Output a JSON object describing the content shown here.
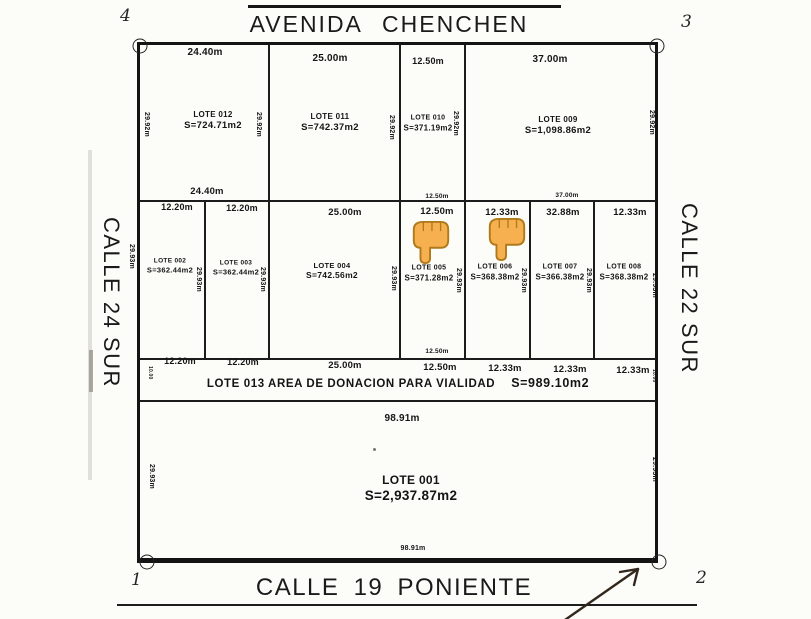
{
  "streets": {
    "top": "AVENIDA CHENCHEN",
    "bottom": "CALLE 19 PONIENTE",
    "left": "CALLE 24 SUR",
    "right": "CALLE 22 SUR"
  },
  "donation_strip": {
    "label": "LOTE 013 AREA DE DONACION PARA VIALIDAD",
    "area": "S=989.10m2"
  },
  "corner_markers": [
    {
      "label": "4",
      "lx": 120,
      "ly": 6,
      "cx": 140,
      "cy": 46
    },
    {
      "label": "3",
      "lx": 681,
      "ly": 12,
      "cx": 657,
      "cy": 46
    },
    {
      "label": "1",
      "lx": 131,
      "ly": 570,
      "cx": 147,
      "cy": 562
    },
    {
      "label": "2",
      "lx": 696,
      "ly": 568,
      "cx": 659,
      "cy": 562
    }
  ],
  "lots": [
    {
      "name": "LOTE 012",
      "area": "S=724.71m2",
      "x": 213,
      "y": 121,
      "fs": 8,
      "fs2": 9.5
    },
    {
      "name": "LOTE 011",
      "area": "S=742.37m2",
      "x": 330,
      "y": 123,
      "fs": 8,
      "fs2": 9.5
    },
    {
      "name": "LOTE 010",
      "area": "S=371.19m2",
      "x": 428,
      "y": 124,
      "fs": 7,
      "fs2": 8
    },
    {
      "name": "LOTE 009",
      "area": "S=1,098.86m2",
      "x": 558,
      "y": 126,
      "fs": 8,
      "fs2": 9.5
    },
    {
      "name": "LOTE 002",
      "area": "S=362.44m2",
      "x": 170,
      "y": 266,
      "fs": 6.5,
      "fs2": 7.5
    },
    {
      "name": "LOTE 003",
      "area": "S=362.44m2",
      "x": 236,
      "y": 268,
      "fs": 6.5,
      "fs2": 7.5
    },
    {
      "name": "LOTE 004",
      "area": "S=742.56m2",
      "x": 332,
      "y": 271,
      "fs": 7.5,
      "fs2": 8.5
    },
    {
      "name": "LOTE 005",
      "area": "S=371.28m2",
      "x": 429,
      "y": 274,
      "fs": 7,
      "fs2": 8
    },
    {
      "name": "LOTE 006",
      "area": "S=368.38m2",
      "x": 495,
      "y": 273,
      "fs": 7,
      "fs2": 8
    },
    {
      "name": "LOTE 007",
      "area": "S=366.38m2",
      "x": 560,
      "y": 273,
      "fs": 7,
      "fs2": 8
    },
    {
      "name": "LOTE 008",
      "area": "S=368.38m2",
      "x": 624,
      "y": 273,
      "fs": 7,
      "fs2": 8
    },
    {
      "name": "LOTE 001",
      "area": "S=2,937.87m2",
      "x": 411,
      "y": 489,
      "fs": 12,
      "fs2": 13.5
    }
  ],
  "dim_labels": [
    {
      "t": "24.40m",
      "x": 205,
      "y": 47,
      "fs": 10
    },
    {
      "t": "25.00m",
      "x": 330,
      "y": 53,
      "fs": 10
    },
    {
      "t": "12.50m",
      "x": 428,
      "y": 56,
      "fs": 9
    },
    {
      "t": "37.00m",
      "x": 550,
      "y": 54,
      "fs": 10
    },
    {
      "t": "24.40m",
      "x": 207,
      "y": 186,
      "fs": 9.5
    },
    {
      "t": "12.50m",
      "x": 437,
      "y": 193,
      "fs": 6.5
    },
    {
      "t": "37.00m",
      "x": 567,
      "y": 192,
      "fs": 6.5
    },
    {
      "t": "12.20m",
      "x": 177,
      "y": 202,
      "fs": 9
    },
    {
      "t": "12.20m",
      "x": 242,
      "y": 203,
      "fs": 9
    },
    {
      "t": "25.00m",
      "x": 345,
      "y": 207,
      "fs": 9.5
    },
    {
      "t": "12.50m",
      "x": 437,
      "y": 206,
      "fs": 9.5
    },
    {
      "t": "12.33m",
      "x": 502,
      "y": 207,
      "fs": 9.5
    },
    {
      "t": "32.88m",
      "x": 563,
      "y": 207,
      "fs": 9.5
    },
    {
      "t": "12.33m",
      "x": 630,
      "y": 207,
      "fs": 9.5
    },
    {
      "t": "12.50m",
      "x": 437,
      "y": 348,
      "fs": 6.5
    },
    {
      "t": "12.20m",
      "x": 180,
      "y": 356,
      "fs": 9
    },
    {
      "t": "12.20m",
      "x": 243,
      "y": 357,
      "fs": 9
    },
    {
      "t": "25.00m",
      "x": 345,
      "y": 360,
      "fs": 9.5
    },
    {
      "t": "12.50m",
      "x": 440,
      "y": 362,
      "fs": 9.5
    },
    {
      "t": "12.33m",
      "x": 505,
      "y": 363,
      "fs": 9.5
    },
    {
      "t": "12.33m",
      "x": 570,
      "y": 364,
      "fs": 9.5
    },
    {
      "t": "12.33m",
      "x": 633,
      "y": 365,
      "fs": 9.5
    },
    {
      "t": "98.91m",
      "x": 402,
      "y": 413,
      "fs": 10
    },
    {
      "t": "98.91m",
      "x": 413,
      "y": 545,
      "fs": 7
    }
  ],
  "vertical_dim_labels": [
    {
      "t": "29.92m",
      "x": 146,
      "y": 125
    },
    {
      "t": "29.92m",
      "x": 258,
      "y": 125
    },
    {
      "t": "29.92m",
      "x": 391,
      "y": 128
    },
    {
      "t": "29.92m",
      "x": 455,
      "y": 124
    },
    {
      "t": "29.92m",
      "x": 651,
      "y": 123
    },
    {
      "t": "29.93m",
      "x": 131,
      "y": 257
    },
    {
      "t": "29.93m",
      "x": 198,
      "y": 280
    },
    {
      "t": "29.93m",
      "x": 262,
      "y": 280
    },
    {
      "t": "29.93m",
      "x": 393,
      "y": 279
    },
    {
      "t": "29.93m",
      "x": 458,
      "y": 281
    },
    {
      "t": "29.93m",
      "x": 523,
      "y": 281
    },
    {
      "t": "29.93m",
      "x": 588,
      "y": 281
    },
    {
      "t": "29.93m",
      "x": 654,
      "y": 286
    },
    {
      "t": "10.00",
      "x": 150,
      "y": 374,
      "fs": 5
    },
    {
      "t": "10.00",
      "x": 654,
      "y": 377,
      "fs": 5
    },
    {
      "t": "29.93m",
      "x": 151,
      "y": 477
    },
    {
      "t": "29.93m",
      "x": 654,
      "y": 470
    }
  ],
  "lines": {
    "h": [
      {
        "x": 140,
        "y": 200,
        "w": 516
      },
      {
        "x": 140,
        "y": 358,
        "w": 516
      },
      {
        "x": 140,
        "y": 400,
        "w": 516
      }
    ],
    "v": [
      {
        "x": 268,
        "y": 45,
        "h": 155
      },
      {
        "x": 399,
        "y": 45,
        "h": 155
      },
      {
        "x": 464,
        "y": 45,
        "h": 155
      },
      {
        "x": 204,
        "y": 200,
        "h": 158
      },
      {
        "x": 268,
        "y": 200,
        "h": 158
      },
      {
        "x": 399,
        "y": 200,
        "h": 158
      },
      {
        "x": 464,
        "y": 200,
        "h": 158
      },
      {
        "x": 529,
        "y": 200,
        "h": 158
      },
      {
        "x": 593,
        "y": 200,
        "h": 158
      }
    ]
  },
  "annotations": {
    "hand_icon": "backhand-index-pointing-down",
    "hand_positions": [
      {
        "x": 409,
        "y": 219
      },
      {
        "x": 485,
        "y": 216
      }
    ],
    "arrow": "hand-drawn arrow pointing at bottom boundary near corner 2"
  },
  "colors": {
    "ink": "#1c1c1c",
    "paper": "#fcfcf9",
    "hand_fill": "#f7b050",
    "hand_stroke": "#b07a1b"
  }
}
